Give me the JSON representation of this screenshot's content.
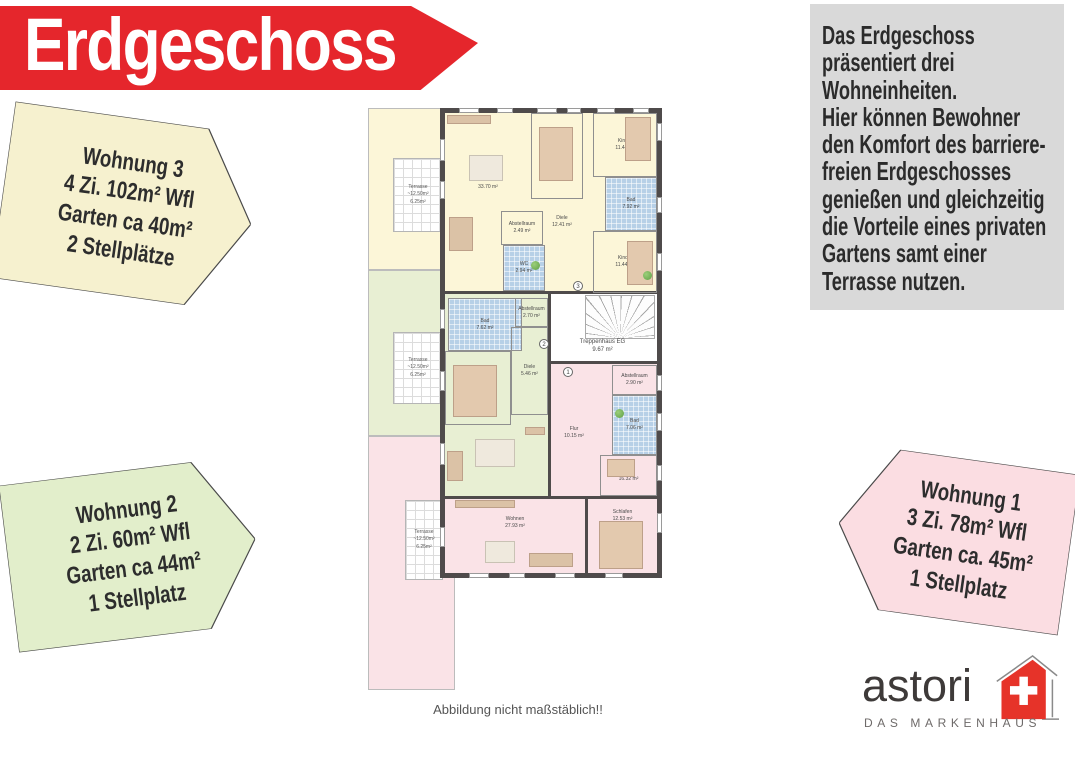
{
  "banner": {
    "title": "Erdgeschoss"
  },
  "description": {
    "text": "Das Erdgeschoss\npräsentiert drei\nWohneinheiten.\nHier können Bewohner\nden Komfort des barriere-\nfreien Erdgeschosses\ngenießen und gleichzeitig\ndie Vorteile eines privaten\nGartens samt einer\nTerrasse nutzen."
  },
  "badges": {
    "w3": {
      "lines": [
        "Wohnung 3",
        "4 Zi. 102m² Wfl",
        "Garten ca 40m²",
        "2 Stellplätze"
      ]
    },
    "w2": {
      "lines": [
        "Wohnung 2",
        "2 Zi. 60m² Wfl",
        "Garten ca 44m²",
        "1 Stellplatz"
      ]
    },
    "w1": {
      "lines": [
        "Wohnung 1",
        "3 Zi. 78m² Wfl",
        "Garten ca. 45m²",
        "1 Stellplatz"
      ]
    }
  },
  "plan": {
    "caption": "Abbildung nicht maßstäblich!!",
    "terrace_label": "Terrasse\n~12.50m²\n6.25m²",
    "markers": {
      "m1": "1",
      "m2": "2",
      "m3": "3"
    },
    "rooms": {
      "w3_wohnen": {
        "name": "Wohnen",
        "area": "33.70 m²"
      },
      "w3_schlafen": {
        "name": "Schlafen",
        "area": "15.08 m²"
      },
      "w3_kind1": {
        "name": "Kind 1",
        "area": "11.44 m²"
      },
      "w3_diele": {
        "name": "Diele",
        "area": "12.41 m²"
      },
      "w3_bad": {
        "name": "Bad",
        "area": "7.92 m²"
      },
      "w3_abstell": {
        "name": "Abstellraum",
        "area": "2.49 m²"
      },
      "w3_wc": {
        "name": "WC",
        "area": "2.94 m²"
      },
      "w3_kind2": {
        "name": "Kind 2",
        "area": "11.44 m²"
      },
      "stair": {
        "name": "Treppenhaus EG",
        "area": "9.67 m²"
      },
      "w2_bad": {
        "name": "Bad",
        "area": "7.62 m²"
      },
      "w2_abstell": {
        "name": "Abstellraum",
        "area": "2.70 m²"
      },
      "w2_schlafen": {
        "name": "Schlafen",
        "area": "13.76 m²"
      },
      "w2_diele": {
        "name": "Diele",
        "area": "5.46 m²"
      },
      "w2_wohnen": {
        "name": "Wohnen",
        "area": "24.54 m²"
      },
      "w1_abstell": {
        "name": "Abstellraum",
        "area": "2.90 m²"
      },
      "w1_flur": {
        "name": "Flur",
        "area": "10.15 m²"
      },
      "w1_bad": {
        "name": "Bad",
        "area": "7.06 m²"
      },
      "w1_kind": {
        "name": "Kind",
        "area": "16.32 m²"
      },
      "w1_wohnen": {
        "name": "Wohnen",
        "area": "27.93 m²"
      },
      "w1_schlafen": {
        "name": "Schlafen",
        "area": "12.53 m²"
      }
    }
  },
  "logo": {
    "name": "astori",
    "tagline": "DAS MARKENHAUS"
  },
  "colors": {
    "banner": "#e5262c",
    "badge_yellow": "#f6f1cf",
    "badge_green": "#e2eecb",
    "badge_pink": "#fbdde2",
    "plan_yellow": "#fcf6d8",
    "plan_green": "#e8efd3",
    "plan_pink": "#fae3e7",
    "bath": "#b7d0e7",
    "wall": "#4f4b4b",
    "graybox": "#d9d9d9",
    "logo_red": "#e63329"
  }
}
